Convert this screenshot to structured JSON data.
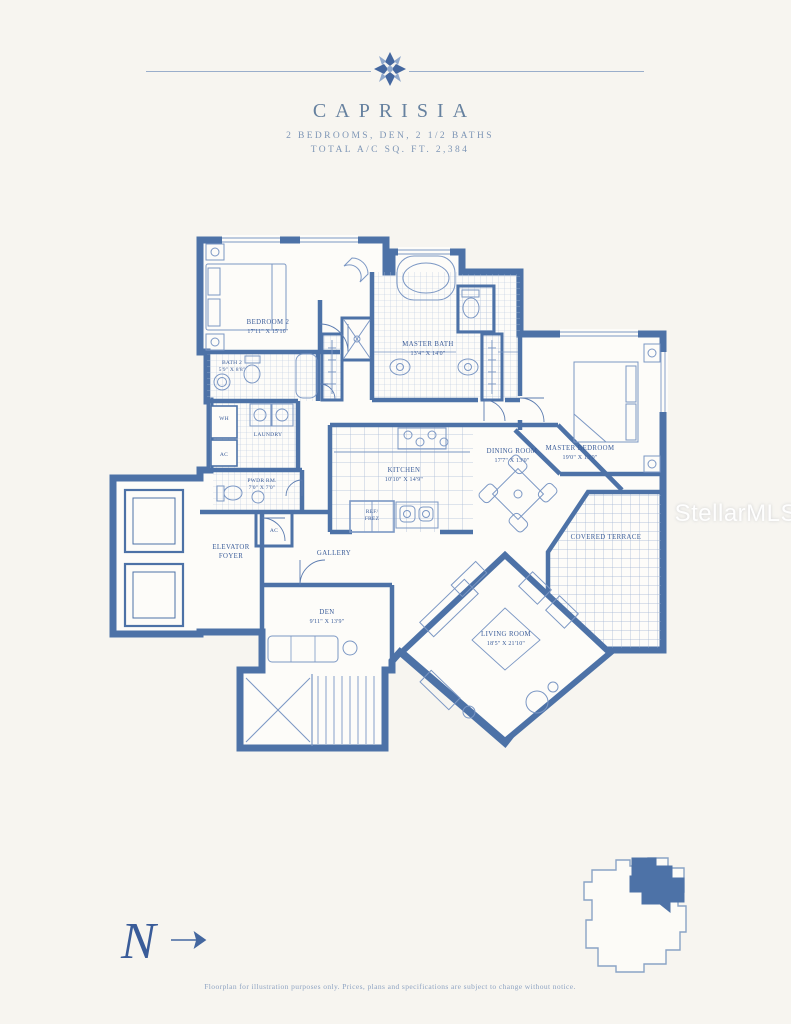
{
  "header": {
    "title": "CAPRISIA",
    "subtitle": "2 BEDROOMS, DEN, 2 1/2 BATHS",
    "total_line": "TOTAL A/C SQ. FT. 2,384"
  },
  "plan": {
    "bedroom2": {
      "name": "BEDROOM 2",
      "dims": "17'11\" X 15'10\""
    },
    "bath2": {
      "name": "BATH 2",
      "dims": "5'9\" X 8'8\""
    },
    "master_bath": {
      "name": "MASTER BATH",
      "dims": "13'4\" X 14'0\""
    },
    "master_bedroom": {
      "name": "MASTER BEDROOM",
      "dims": "19'0\" X 13'0\""
    },
    "laundry": {
      "name": "LAUNDRY"
    },
    "water_heater": {
      "name": "WH"
    },
    "ac_closet_1": {
      "name": "AC"
    },
    "powder_room": {
      "name": "PWDR RM.",
      "dims": "7'0\" X 7'0\""
    },
    "ac_closet_2": {
      "name": "AC"
    },
    "elevator_foyer": {
      "line1": "ELEVATOR",
      "line2": "FOYER"
    },
    "gallery": {
      "name": "GALLERY"
    },
    "kitchen": {
      "name": "KITCHEN",
      "dims": "10'10\" X 14'9\""
    },
    "refrigerator": {
      "line1": "REF/",
      "line2": "FREZ"
    },
    "dining_room": {
      "name": "DINING ROOM",
      "dims": "17'7\" X 13'0\""
    },
    "covered_terrace": {
      "name": "COVERED TERRACE"
    },
    "living_room": {
      "name": "LIVING ROOM",
      "dims": "18'5\" X 21'10\""
    },
    "den": {
      "name": "DEN",
      "dims": "9'11\" X 13'9\""
    }
  },
  "footer": {
    "disclaimer": "Floorplan for illustration purposes only. Prices, plans and specifications are subject to change without notice.",
    "compass_letter": "N"
  },
  "watermark": {
    "text": "StellarMLS"
  },
  "colors": {
    "wall": "#4d72a7",
    "thin_line": "#7b97c4",
    "label_text": "#3a5c99",
    "header_text": "#66819f",
    "page_background": "#f7f5f0",
    "keyplan_highlight": "#4d72a7"
  }
}
